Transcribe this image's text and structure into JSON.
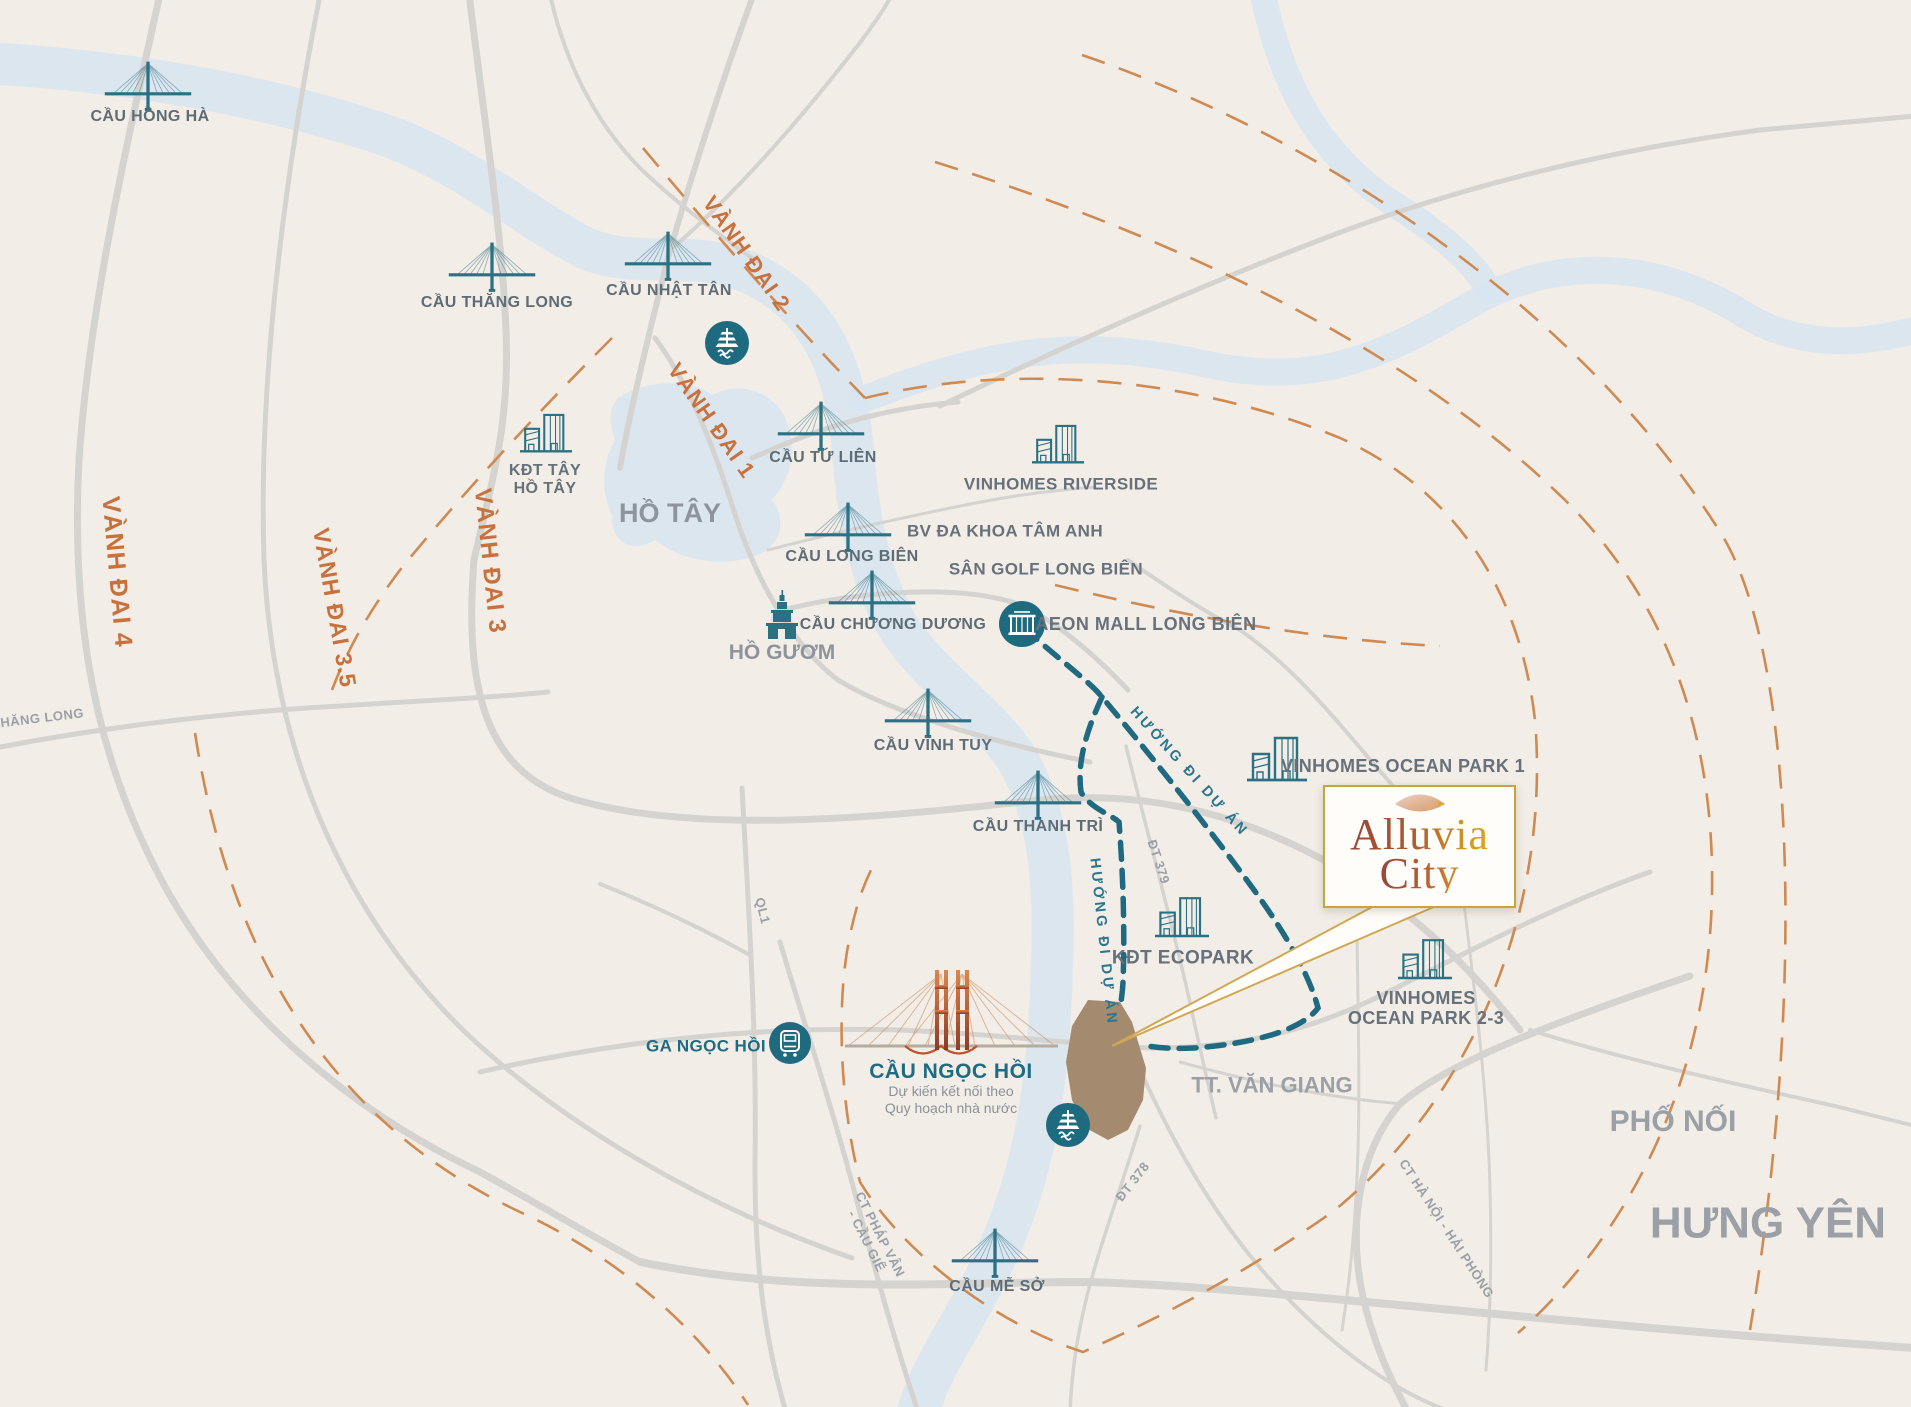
{
  "brand": {
    "line1": "Alluvia",
    "line2": "City"
  },
  "bridges": {
    "hong_ha": "CẦU HỒNG HÀ",
    "thang_long": "CẦU THĂNG LONG",
    "nhat_tan": "CẦU NHẬT TÂN",
    "tu_lien": "CẦU TỨ LIÊN",
    "long_bien": "CẦU LONG BIÊN",
    "chuong_duong": "CẦU CHƯƠNG DƯƠNG",
    "vinh_tuy": "CẦU VĨNH TUY",
    "thanh_tri": "CẦU THANH TRÌ",
    "me_so": "CẦU MỄ SỞ",
    "ngoc_hoi": "CẦU NGỌC HỒI",
    "ngoc_hoi_note1": "Dự kiến kết nối theo",
    "ngoc_hoi_note2": "Quy hoạch nhà nước"
  },
  "transit": {
    "ga_ngoc_hoi": "GA NGỌC HỒI"
  },
  "landmarks": {
    "kdt_tay_ho_tay1": "KĐT TÂY",
    "kdt_tay_ho_tay2": "HỒ TÂY",
    "vinhomes_riverside": "VINHOMES RIVERSIDE",
    "bv_tam_anh": "BV ĐA KHOA TÂM ANH",
    "san_golf": "SÂN GOLF LONG BIÊN",
    "aeon_mall": "AEON MALL LONG BIÊN",
    "vinhomes_op1": "VINHOMES OCEAN PARK 1",
    "kdt_ecopark": "KĐT ECOPARK",
    "vinhomes_op23_1": "VINHOMES",
    "vinhomes_op23_2": "OCEAN PARK 2-3"
  },
  "waters": {
    "ho_tay": "HỒ TÂY",
    "ho_guom": "HỒ GƯƠM"
  },
  "areas": {
    "tt_van_giang": "TT. VĂN GIANG",
    "pho_noi": "PHỐ NỐI",
    "hung_yen": "HƯNG YÊN"
  },
  "ring_roads": {
    "vanh_dai_1": "VÀNH ĐAI 1",
    "vanh_dai_2": "VÀNH ĐAI 2",
    "vanh_dai_3": "VÀNH ĐAI 3",
    "vanh_dai_3_5": "VÀNH ĐAI 3.5",
    "vanh_dai_4": "VÀNH ĐAI 4"
  },
  "roads": {
    "thang_long_blvd": "THĂNG LONG",
    "ql1": "QL1",
    "dt_379": "ĐT 379",
    "dt_378": "ĐT 378",
    "ct_phap_van1": "CT PHÁP VÂN",
    "ct_phap_van2": "- CẦU GIẼ",
    "ct_ha_noi_hai_phong": "CT HÀ NỘI - HẢI PHÒNG"
  },
  "routes": {
    "direction_to_project": "HƯỚNG ĐI DỰ ÁN"
  },
  "colors": {
    "icon_teal": "#2b7183",
    "route_teal": "#1f6a80",
    "ring_orange": "#c8713d",
    "site_brown": "#a48b70",
    "card_gold": "#c9a243",
    "water_blue": "#d8e4f0"
  }
}
